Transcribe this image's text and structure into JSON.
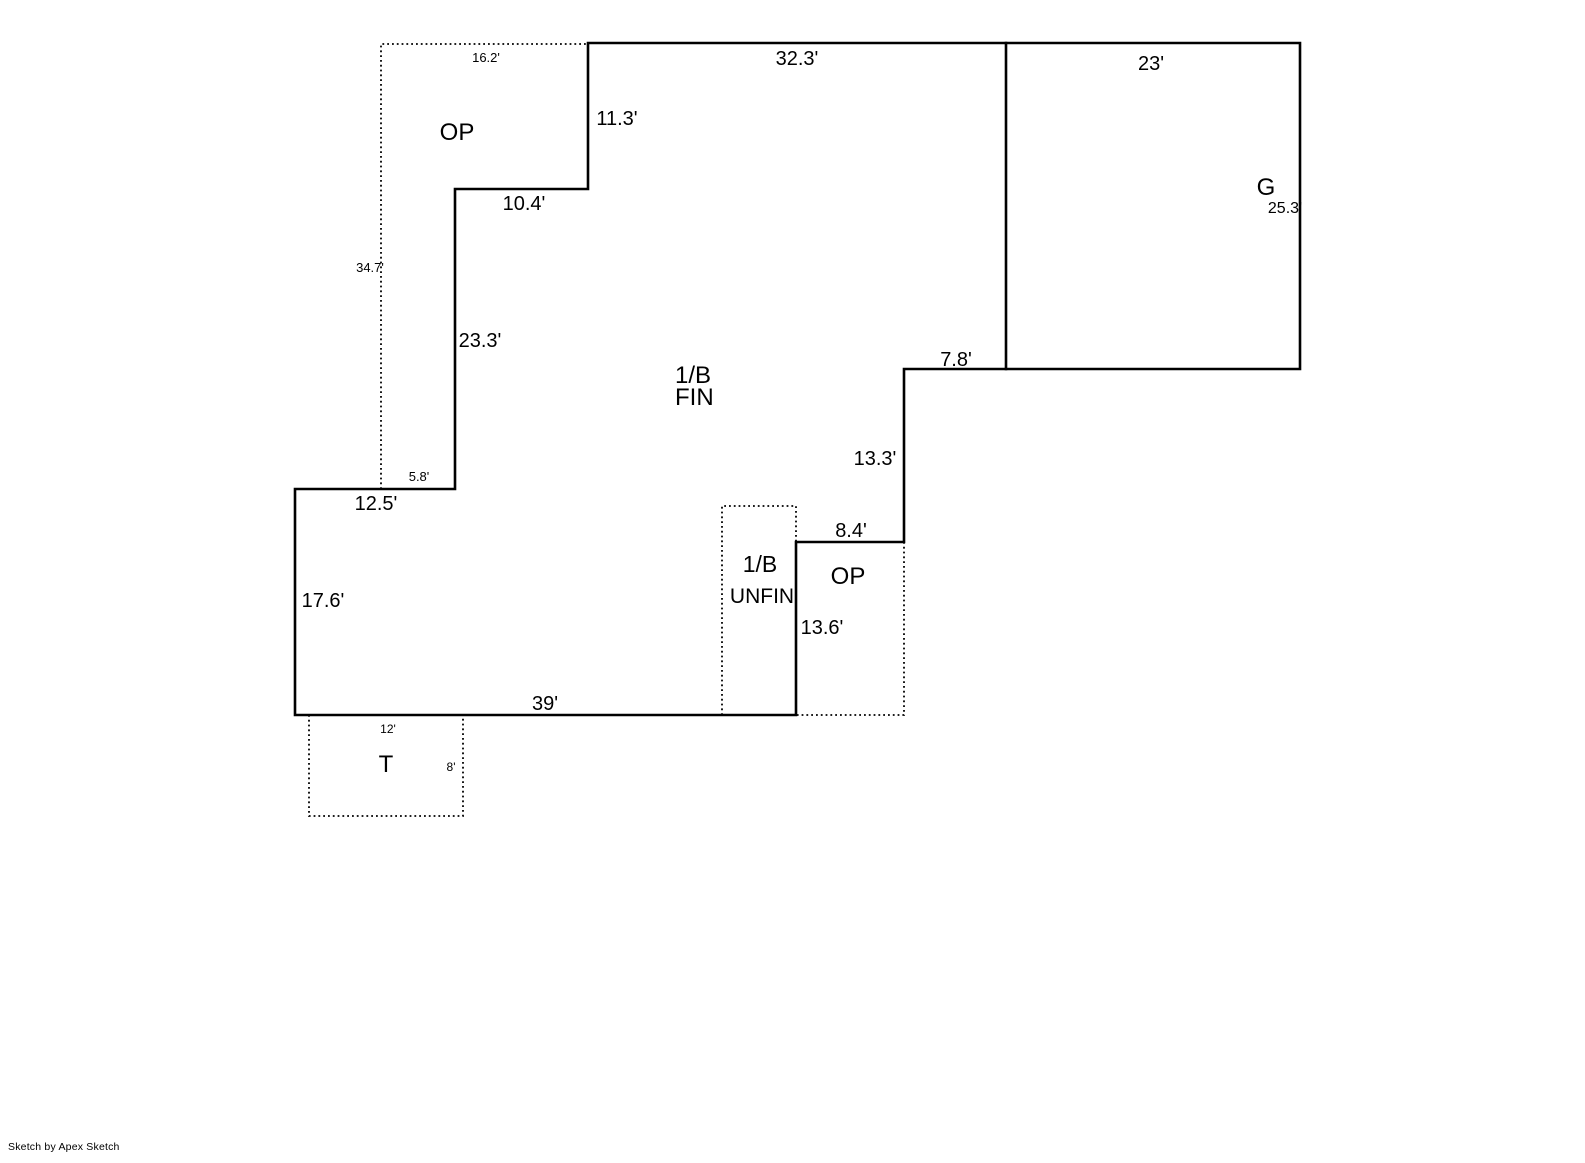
{
  "page": {
    "background": "#ffffff",
    "ink": "#000000"
  },
  "footer": {
    "credit": "Sketch by Apex Sketch"
  },
  "floorplan": {
    "areas": {
      "open_porch_upper": "OP",
      "garage": "G",
      "basement_finished_line1": "1/B",
      "basement_finished_line2": "FIN",
      "basement_unfinished_line1": "1/B",
      "basement_unfinished_line2": "UNFIN",
      "open_porch_lower": "OP",
      "terrace": "T"
    },
    "dimensions": {
      "op_upper_top": "16.2'",
      "main_top": "32.3'",
      "garage_top": "23'",
      "main_upper_right": "11.3'",
      "op_upper_step": "10.4'",
      "garage_right": "25.3'",
      "op_upper_left": "34.7'",
      "main_mid_left": "23.3'",
      "rear_step_top": "7.8'",
      "rear_step_right": "13.3'",
      "op_upper_bottom": "5.8'",
      "main_step_bottom": "12.5'",
      "op_lower_top": "8.4'",
      "main_lower_left": "17.6'",
      "op_lower_right": "13.6'",
      "main_bottom": "39'",
      "terrace_top": "12'",
      "terrace_right": "8'"
    }
  }
}
